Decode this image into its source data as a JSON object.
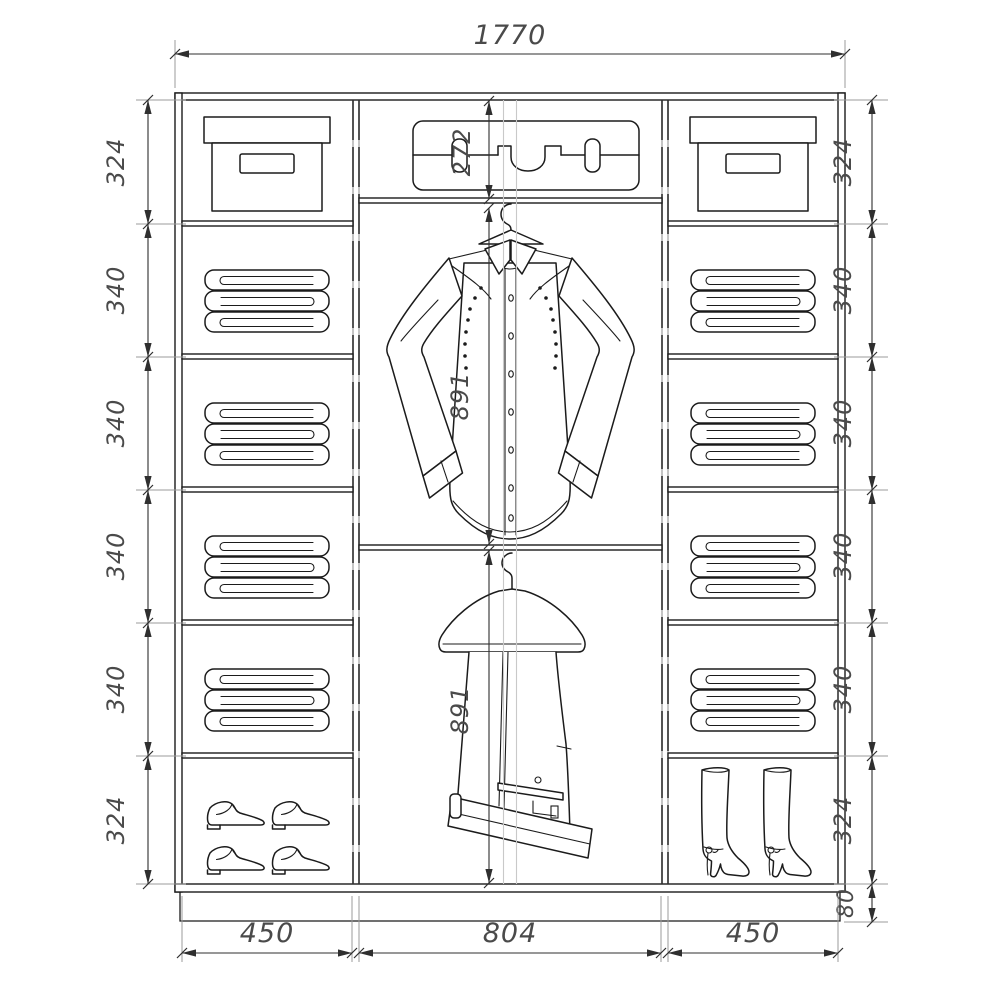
{
  "dims": {
    "total_width": "1770",
    "left_chain": [
      "324",
      "340",
      "340",
      "340",
      "340",
      "324"
    ],
    "right_chain": [
      "324",
      "340",
      "340",
      "340",
      "340",
      "324"
    ],
    "plinth_height": "80",
    "bottom_widths": [
      "450",
      "804",
      "450"
    ],
    "middle_top_shelf": "272",
    "middle_upper_hanging": "891",
    "middle_lower_hanging": "891"
  },
  "icons": {
    "storage_box": "storage-box-icon",
    "folded_linen": "folded-linen-icon",
    "mens_shoes": "mens-shoes-icon",
    "womens_boots": "womens-boots-icon",
    "suitcase": "suitcase-icon",
    "shirt": "shirt-on-hanger-icon",
    "trousers": "trousers-on-hanger-icon"
  },
  "colors": {
    "line": "#1b1b1b",
    "dimension": "#2f2f2f",
    "extension": "#9b9b9b",
    "text": "#4a4a4a",
    "background": "#ffffff"
  }
}
